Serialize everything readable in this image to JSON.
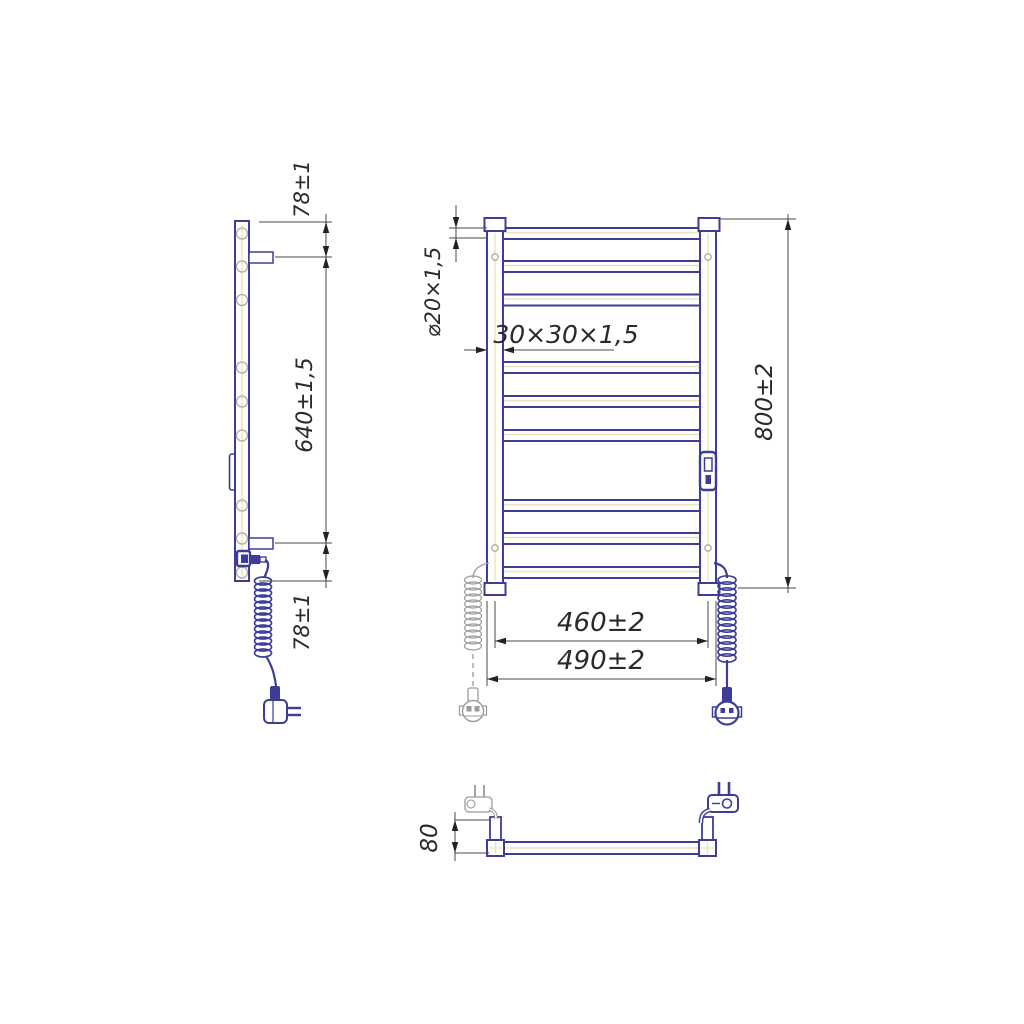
{
  "drawing": {
    "views": {
      "side": {
        "dim_top_offset": "78±1",
        "dim_mount_span": "640±1,5",
        "dim_bottom_offset": "78±1"
      },
      "front": {
        "dim_tube_section": "⌀20×1,5",
        "dim_post_profile": "30×30×1,5",
        "dim_height": "800±2",
        "dim_rail_span": "460±2",
        "dim_overall_width": "490±2",
        "rung_count": 9
      },
      "top": {
        "dim_depth": "80"
      }
    },
    "colors": {
      "outline": "#3d3d99",
      "dimension_lines": "#4a4a4a",
      "centerline": "#e9e0c0",
      "phantom": "#9a9a9a"
    }
  }
}
